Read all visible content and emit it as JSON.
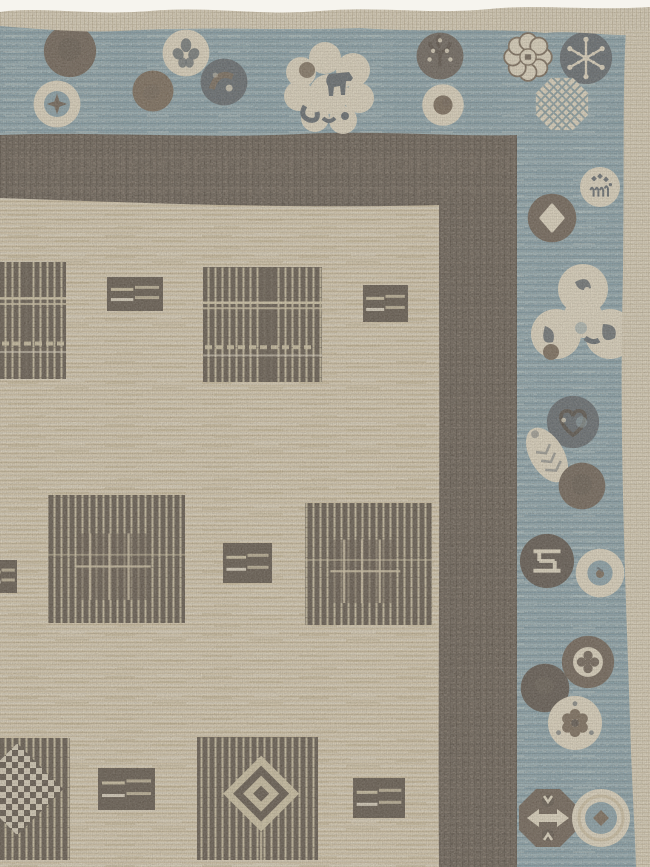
{
  "meta": {
    "description": "Photograph of the corner of a hand-woven rug: a cream field with dark brown striped plaid squares and small striped rectangles, framed by a dark brown guard border and an outer slate-blue border filled with circular medallions, edged by a cream selvage."
  },
  "colors": {
    "bg": "#f6f4ee",
    "selvage": "#e6dcc3",
    "selvage_shade": "#cfc2a3",
    "blue": "#7fa0ae",
    "blue_light": "#a3c0c8",
    "blue_pale": "#c6d8da",
    "blue_dark": "#5f8799",
    "darkband": "#564c42",
    "darkband_light": "#7a6e60",
    "darkband_shadow": "#3d352d",
    "field": "#decfb0",
    "field_light": "#ede5d0",
    "field_streak": "#c0ae85",
    "motif_brown": "#4c4237",
    "motif_stripe": "#d9cdaa",
    "med_cream": "#ece3cb",
    "med_brown": "#5d5044",
    "med_brown2": "#6b5b49",
    "med_dark": "#49413a",
    "med_slate": "#4e5a64",
    "med_slate_light": "#8fb0bb"
  },
  "rug": {
    "border_medallions": [
      {
        "kind": "plain-brown",
        "cx": 70,
        "cy": 51,
        "r": 28
      },
      {
        "kind": "star-ring",
        "cx": 57,
        "cy": 104,
        "r": 26
      },
      {
        "kind": "floral-cream",
        "cx": 186,
        "cy": 53,
        "r": 26
      },
      {
        "kind": "plain-brown2",
        "cx": 153,
        "cy": 91,
        "r": 22
      },
      {
        "kind": "swirl-slate",
        "cx": 224,
        "cy": 82,
        "r": 26
      },
      {
        "kind": "horse-cluster",
        "cx": 331,
        "cy": 88,
        "r": 30
      },
      {
        "kind": "tree-dark",
        "cx": 440,
        "cy": 56,
        "r": 26
      },
      {
        "kind": "dot-cream",
        "cx": 443,
        "cy": 105,
        "r": 24
      },
      {
        "kind": "octofoil",
        "cx": 528,
        "cy": 57,
        "r": 27
      },
      {
        "kind": "snowflake",
        "cx": 586,
        "cy": 58,
        "r": 28
      },
      {
        "kind": "lattice-oct",
        "cx": 562,
        "cy": 104,
        "r": 28
      },
      {
        "kind": "notes-cream",
        "cx": 600,
        "cy": 187,
        "r": 24
      },
      {
        "kind": "diamond-brown",
        "cx": 552,
        "cy": 218,
        "r": 27
      },
      {
        "kind": "trefoil-cluster",
        "cx": 583,
        "cy": 316,
        "r": 30
      },
      {
        "kind": "heart-slate",
        "cx": 573,
        "cy": 422,
        "r": 28
      },
      {
        "kind": "leaf-cream",
        "cx": 547,
        "cy": 455,
        "r": 30
      },
      {
        "kind": "plain-brown",
        "cx": 582,
        "cy": 486,
        "r": 25
      },
      {
        "kind": "fret-dark",
        "cx": 547,
        "cy": 561,
        "r": 29
      },
      {
        "kind": "ring-blue",
        "cx": 600,
        "cy": 573,
        "r": 27
      },
      {
        "kind": "quatrefoil-ring",
        "cx": 588,
        "cy": 662,
        "r": 28
      },
      {
        "kind": "plain-dark",
        "cx": 545,
        "cy": 688,
        "r": 26
      },
      {
        "kind": "flower-cream",
        "cx": 575,
        "cy": 723,
        "r": 29
      },
      {
        "kind": "arrows-oct",
        "cx": 548,
        "cy": 818,
        "r": 30
      },
      {
        "kind": "ring-diamond",
        "cx": 601,
        "cy": 818,
        "r": 30
      }
    ],
    "field_motifs": [
      {
        "kind": "plaid-sq",
        "x": -22,
        "y": 262,
        "w": 88,
        "h": 117
      },
      {
        "kind": "stripe-rect",
        "x": 107,
        "y": 277,
        "w": 56,
        "h": 34
      },
      {
        "kind": "plaid-sq",
        "x": 203,
        "y": 267,
        "w": 119,
        "h": 115
      },
      {
        "kind": "stripe-rect",
        "x": 363,
        "y": 285,
        "w": 45,
        "h": 37
      },
      {
        "kind": "stripe-rect",
        "x": -14,
        "y": 560,
        "w": 31,
        "h": 33
      },
      {
        "kind": "grid-sq",
        "x": 48,
        "y": 495,
        "w": 137,
        "h": 128
      },
      {
        "kind": "stripe-rect",
        "x": 223,
        "y": 543,
        "w": 49,
        "h": 40
      },
      {
        "kind": "grid-sq",
        "x": 305,
        "y": 503,
        "w": 127,
        "h": 122
      },
      {
        "kind": "checker-sq",
        "x": -26,
        "y": 738,
        "w": 96,
        "h": 122
      },
      {
        "kind": "stripe-rect",
        "x": 98,
        "y": 768,
        "w": 57,
        "h": 42
      },
      {
        "kind": "diamond-sq",
        "x": 197,
        "y": 737,
        "w": 121,
        "h": 123
      },
      {
        "kind": "stripe-rect",
        "x": 353,
        "y": 778,
        "w": 52,
        "h": 40
      }
    ]
  }
}
